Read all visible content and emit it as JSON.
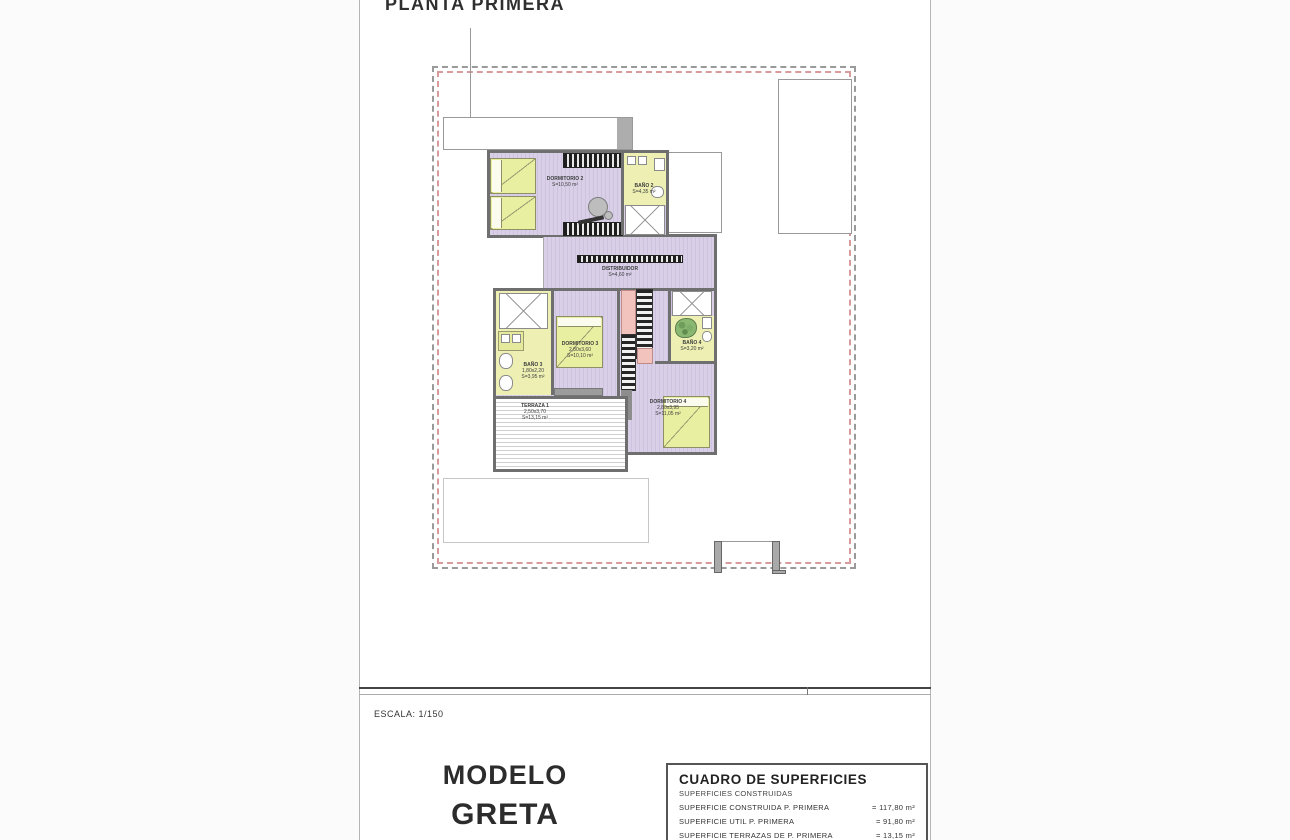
{
  "page": {
    "title": "PLANTA PRIMERA",
    "scale_label": "ESCALA: 1/150"
  },
  "model": {
    "line1": "MODELO",
    "line2": "GRETA",
    "line3": "4 DORMITORIOS"
  },
  "surfaces_table": {
    "title": "CUADRO DE SUPERFICIES",
    "subtitle": "SUPERFICIES CONSTRUIDAS",
    "rows": [
      {
        "label": "SUPERFICIE CONSTRUIDA P. PRIMERA",
        "value": "= 117,80 m²"
      },
      {
        "label": "SUPERFICIE UTIL P. PRIMERA",
        "value": "= 91,80 m²"
      },
      {
        "label": "SUPERFICIE TERRAZAS DE P. PRIMERA",
        "value": "= 13,15 m²"
      }
    ]
  },
  "plan": {
    "rooms": [
      {
        "id": "dormitorio-2",
        "name": "DORMITORIO 2",
        "area": "S=10,50 m²"
      },
      {
        "id": "bano-2",
        "name": "BAÑO 2",
        "area": "S=4,35 m²"
      },
      {
        "id": "distribuidor",
        "name": "DISTRIBUIDOR",
        "area": "S=4,60 m²"
      },
      {
        "id": "bano-3",
        "name": "BAÑO 3",
        "dims": "1,80x2,20",
        "area": "S=3,95 m²"
      },
      {
        "id": "dormitorio-3",
        "name": "DORMITORIO 3",
        "dims": "2,80x3,60",
        "area": "S=10,10 m²"
      },
      {
        "id": "bano-4",
        "name": "BAÑO 4",
        "area": "S=3,20 m²"
      },
      {
        "id": "dormitorio-4",
        "name": "DORMITORIO 4",
        "dims": "2,80x3,95",
        "area": "S=11,05 m²"
      },
      {
        "id": "terraza-1",
        "name": "TERRAZA 1",
        "dims": "2,50x3,70",
        "area": "S=13,15 m²"
      }
    ]
  },
  "colors": {
    "wall": "#6f6f6f",
    "floor_purple": "#d6cde6",
    "room_yellow": "#edf0b2",
    "bed_yellow": "#e9efa0",
    "stair_pink": "#f2c3bd",
    "boundary_red": "#d89a9a",
    "boundary_grey": "#9a9a9a"
  }
}
